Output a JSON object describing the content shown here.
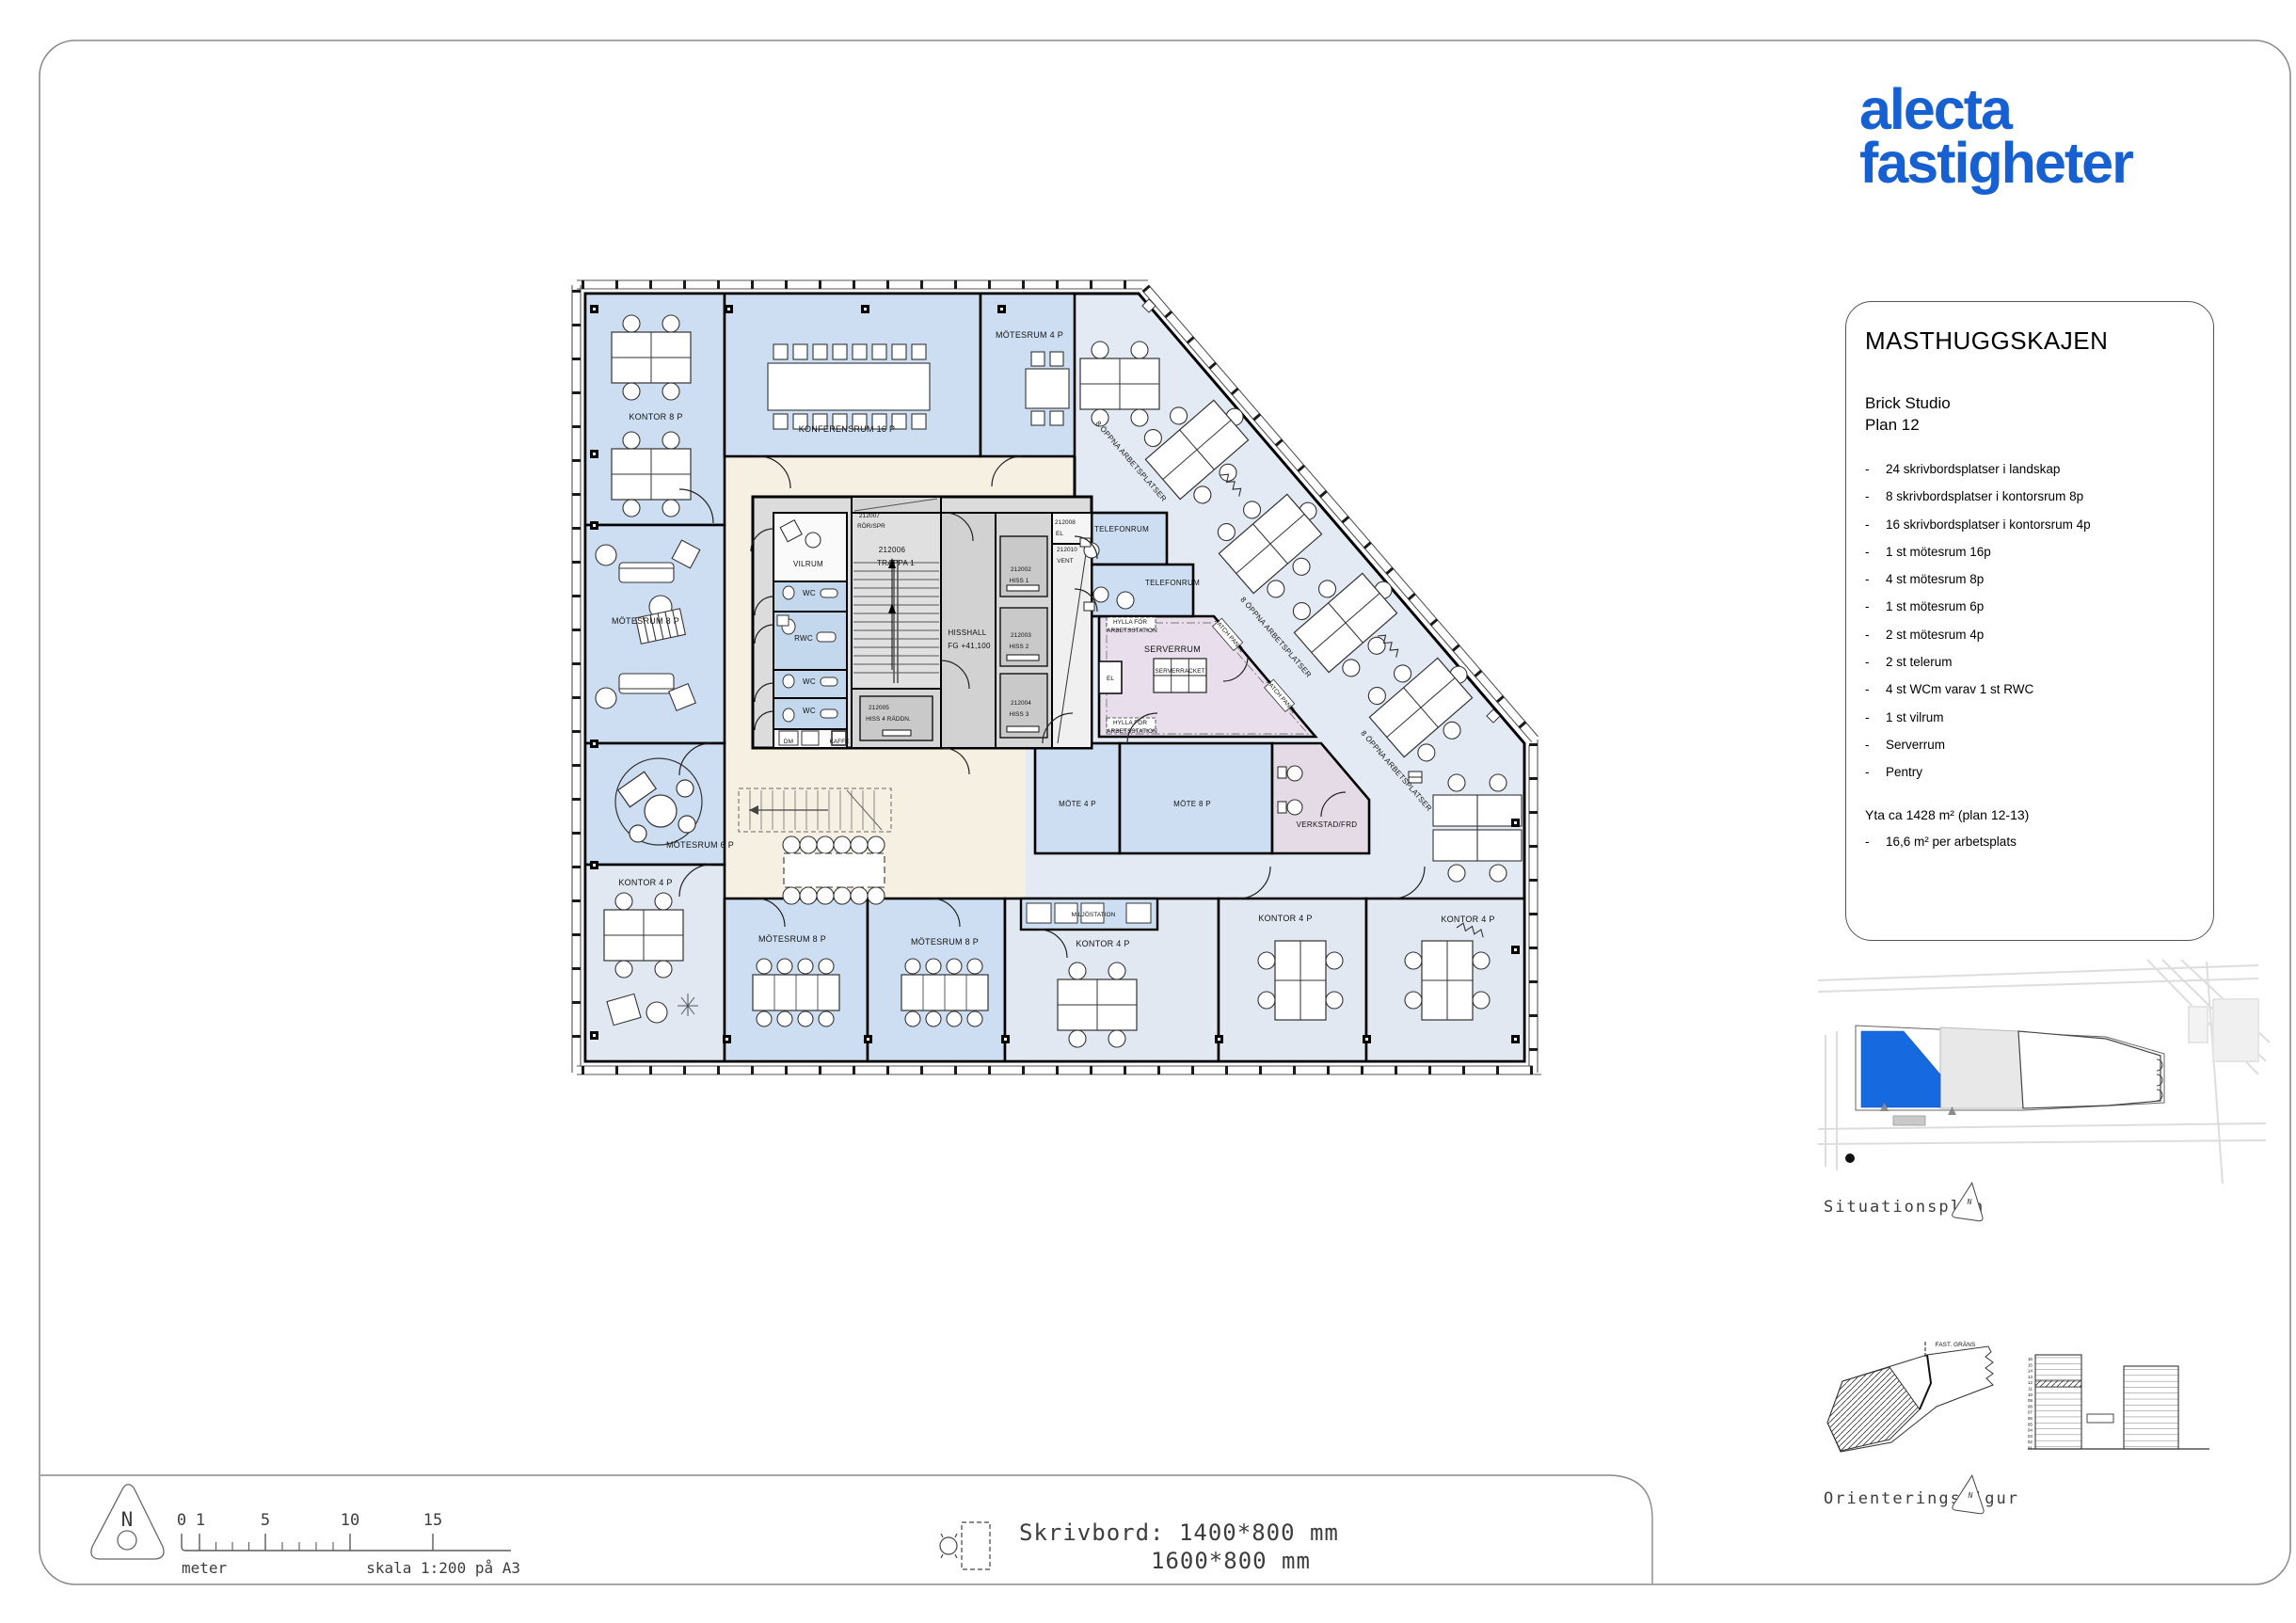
{
  "logo": {
    "line1": "alecta",
    "line2": "fastigheter",
    "color": "#1660d2"
  },
  "info_box": {
    "title": "MASTHUGGSKAJEN",
    "subtitle_line1": "Brick Studio",
    "subtitle_line2": "Plan 12",
    "bullet": "-",
    "items": [
      "24 skrivbordsplatser i landskap",
      "8 skrivbordsplatser i kontorsrum 8p",
      "16 skrivbordsplatser i kontorsrum 4p",
      "1 st mötesrum 16p",
      "4 st mötesrum 8p",
      "1 st mötesrum 6p",
      "2 st mötesrum 4p",
      "2 st telerum",
      "4 st WCm varav 1 st RWC",
      "1 st vilrum",
      "Serverrum",
      "Pentry"
    ],
    "area_line": "Yta ca 1428 m² (plan 12-13)",
    "area_sub": "16,6 m² per arbetsplats"
  },
  "side_figures": {
    "situationsplan_label": "Situationsplan",
    "orienteringsfigur_label": "Orienteringsfigur",
    "fast_grans_label": "FAST. GRÄNS",
    "north_letter": "N",
    "highlight_color": "#1769e0",
    "floors": [
      "16",
      "15",
      "14",
      "13",
      "12",
      "11",
      "10",
      "09",
      "08",
      "07",
      "06",
      "05",
      "04",
      "03",
      "02",
      "01"
    ]
  },
  "legend": {
    "north_letter": "N",
    "scale_ticks": [
      "0",
      "1",
      "5",
      "10",
      "15"
    ],
    "meter_label": "meter",
    "scale_label": "skala 1:200 på A3",
    "desk_line1": "Skrivbord: 1400*800 mm",
    "desk_line2": "1600*800 mm"
  },
  "plan": {
    "labels": [
      "KONTOR 8 P",
      "KONFERENSRUM 16 P",
      "MÖTESRUM 4 P",
      "MÖTESRUM 8 P",
      "MÖTESRUM 6 P",
      "KONTOR 4 P",
      "VILRUM",
      "WC",
      "RWC",
      "WC",
      "WC",
      "DM",
      "KAFFE",
      "212007",
      "RÖR/SPR",
      "212006",
      "TRAPPA 1",
      "HISSHALL",
      "FG +41,100",
      "212002",
      "HISS 1",
      "212003",
      "HISS 2",
      "212004",
      "HISS 3",
      "212005",
      "HISS 4 RÄDDN.",
      "212008",
      "EL",
      "212010",
      "VENT",
      "TELEFONRUM",
      "TELEFONRUM",
      "SERVERRUM",
      "SERVERRACKET",
      "EL",
      "HYLLA FÖR",
      "ARBETSSTATION",
      "HYLLA FÖR",
      "ARBETSSTATION",
      "PATCH PANEL",
      "PATCH PANEL",
      "MÖTE 4 P",
      "MÖTE 8 P",
      "VERKSTAD/FRD",
      "MILJÖSTATION",
      "KONTOR 4 P",
      "KONTOR 4 P",
      "KONTOR 4 P",
      "MÖTESRUM 8 P",
      "MÖTESRUM 8 P",
      "8 ÖPPNA ARBETSPLATSER",
      "8 ÖPPNA ARBETSPLATSER",
      "8 ÖPPNA ARBETSPLATSER"
    ]
  }
}
